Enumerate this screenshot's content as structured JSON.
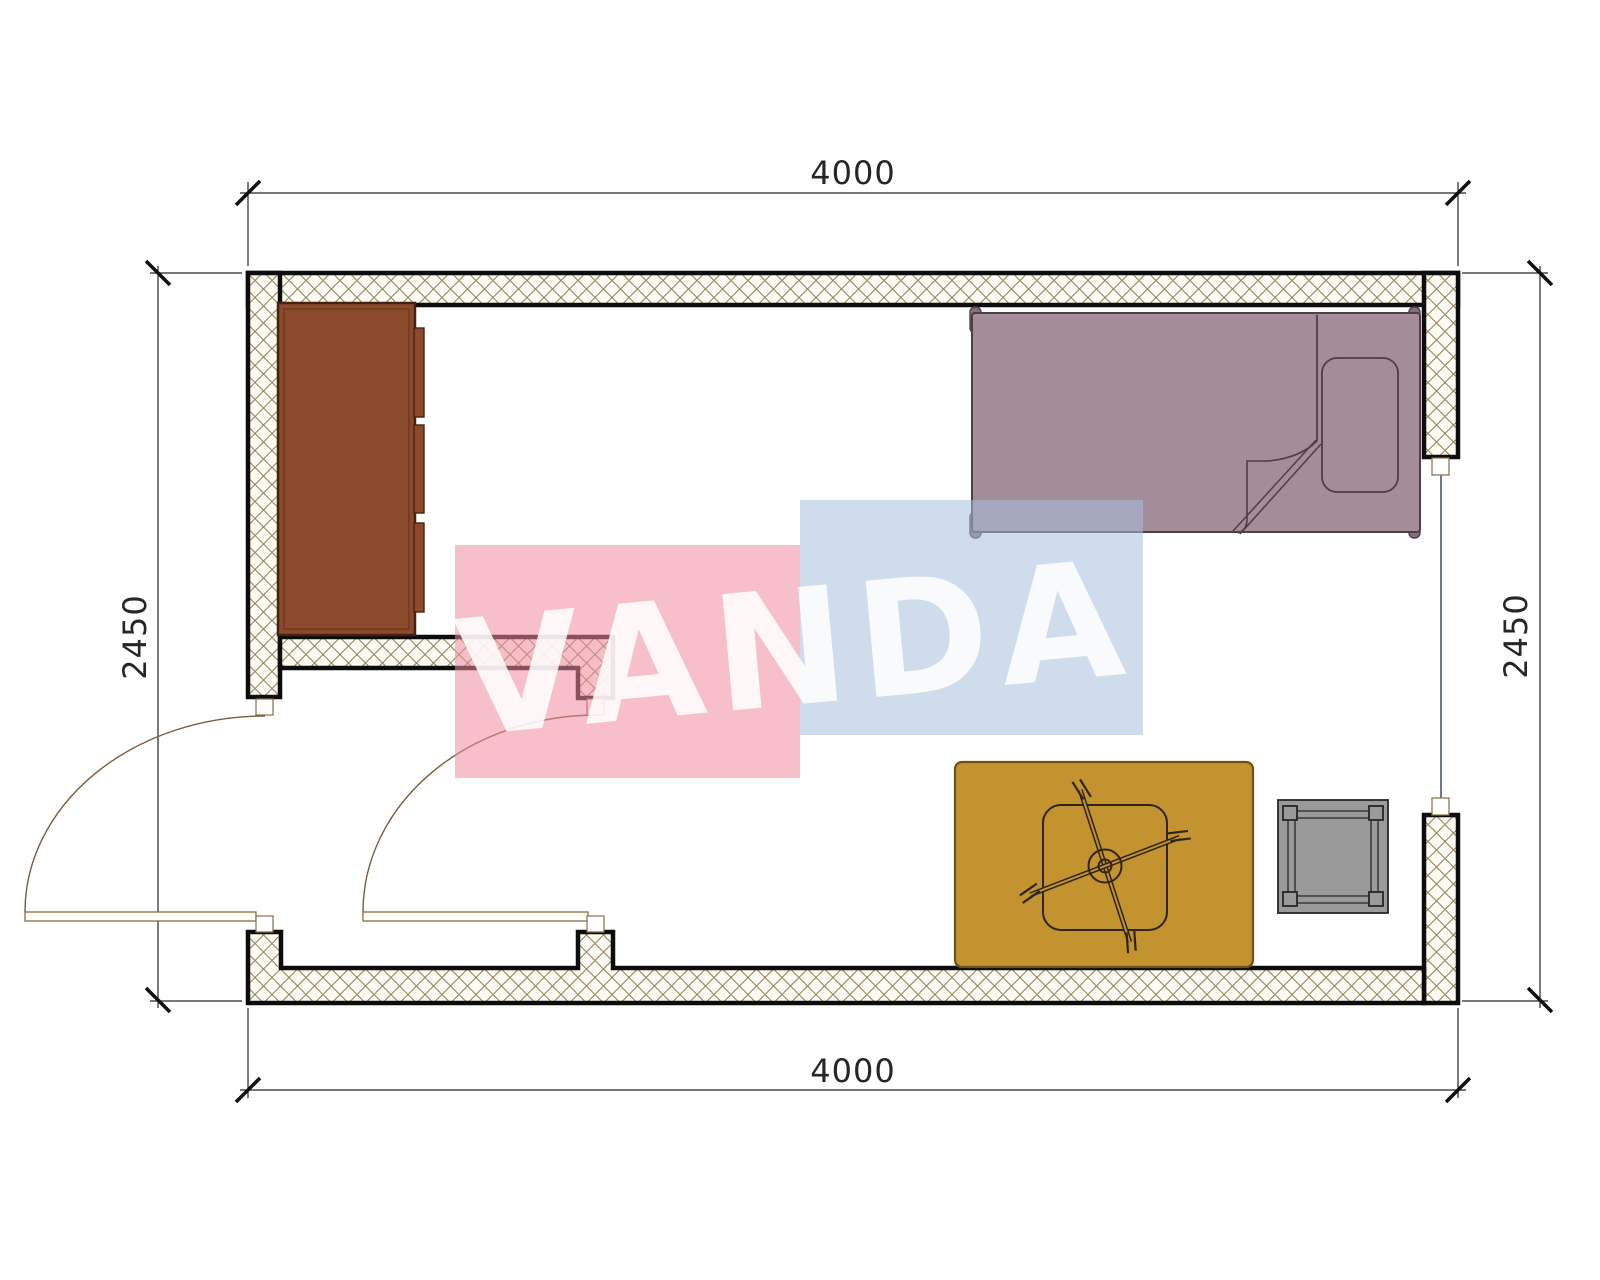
{
  "dimensions": {
    "top": "4000",
    "bottom": "4000",
    "left": "2450",
    "right": "2450"
  },
  "watermark": {
    "text": "VANDA",
    "pink_block": "#EE8B9F",
    "blue_block": "#A8C0DC",
    "text_color": "#FFFFFF"
  },
  "palette": {
    "wall_outline": "#0D0D0D",
    "hatch_line": "#94875F",
    "hatch_bg": "#FCFAF3",
    "dimension_color": "#262626",
    "door_trim": "#8A6B47",
    "window_line": "#4A5670"
  },
  "furniture": {
    "wardrobe": {
      "label": "wardrobe",
      "color": "#8C4A2D",
      "outline": "#49220F"
    },
    "bed": {
      "label": "single bed",
      "color": "#A28D99",
      "outline": "#4E3E47",
      "post_color": "#84707C"
    },
    "rug": {
      "label": "rug",
      "color": "#C3932F",
      "outline": "#6E5014"
    },
    "chair": {
      "label": "swivel chair",
      "line_color": "#2E2416"
    },
    "stool": {
      "label": "stool",
      "color": "#9A9A9A",
      "outline": "#262626"
    }
  }
}
